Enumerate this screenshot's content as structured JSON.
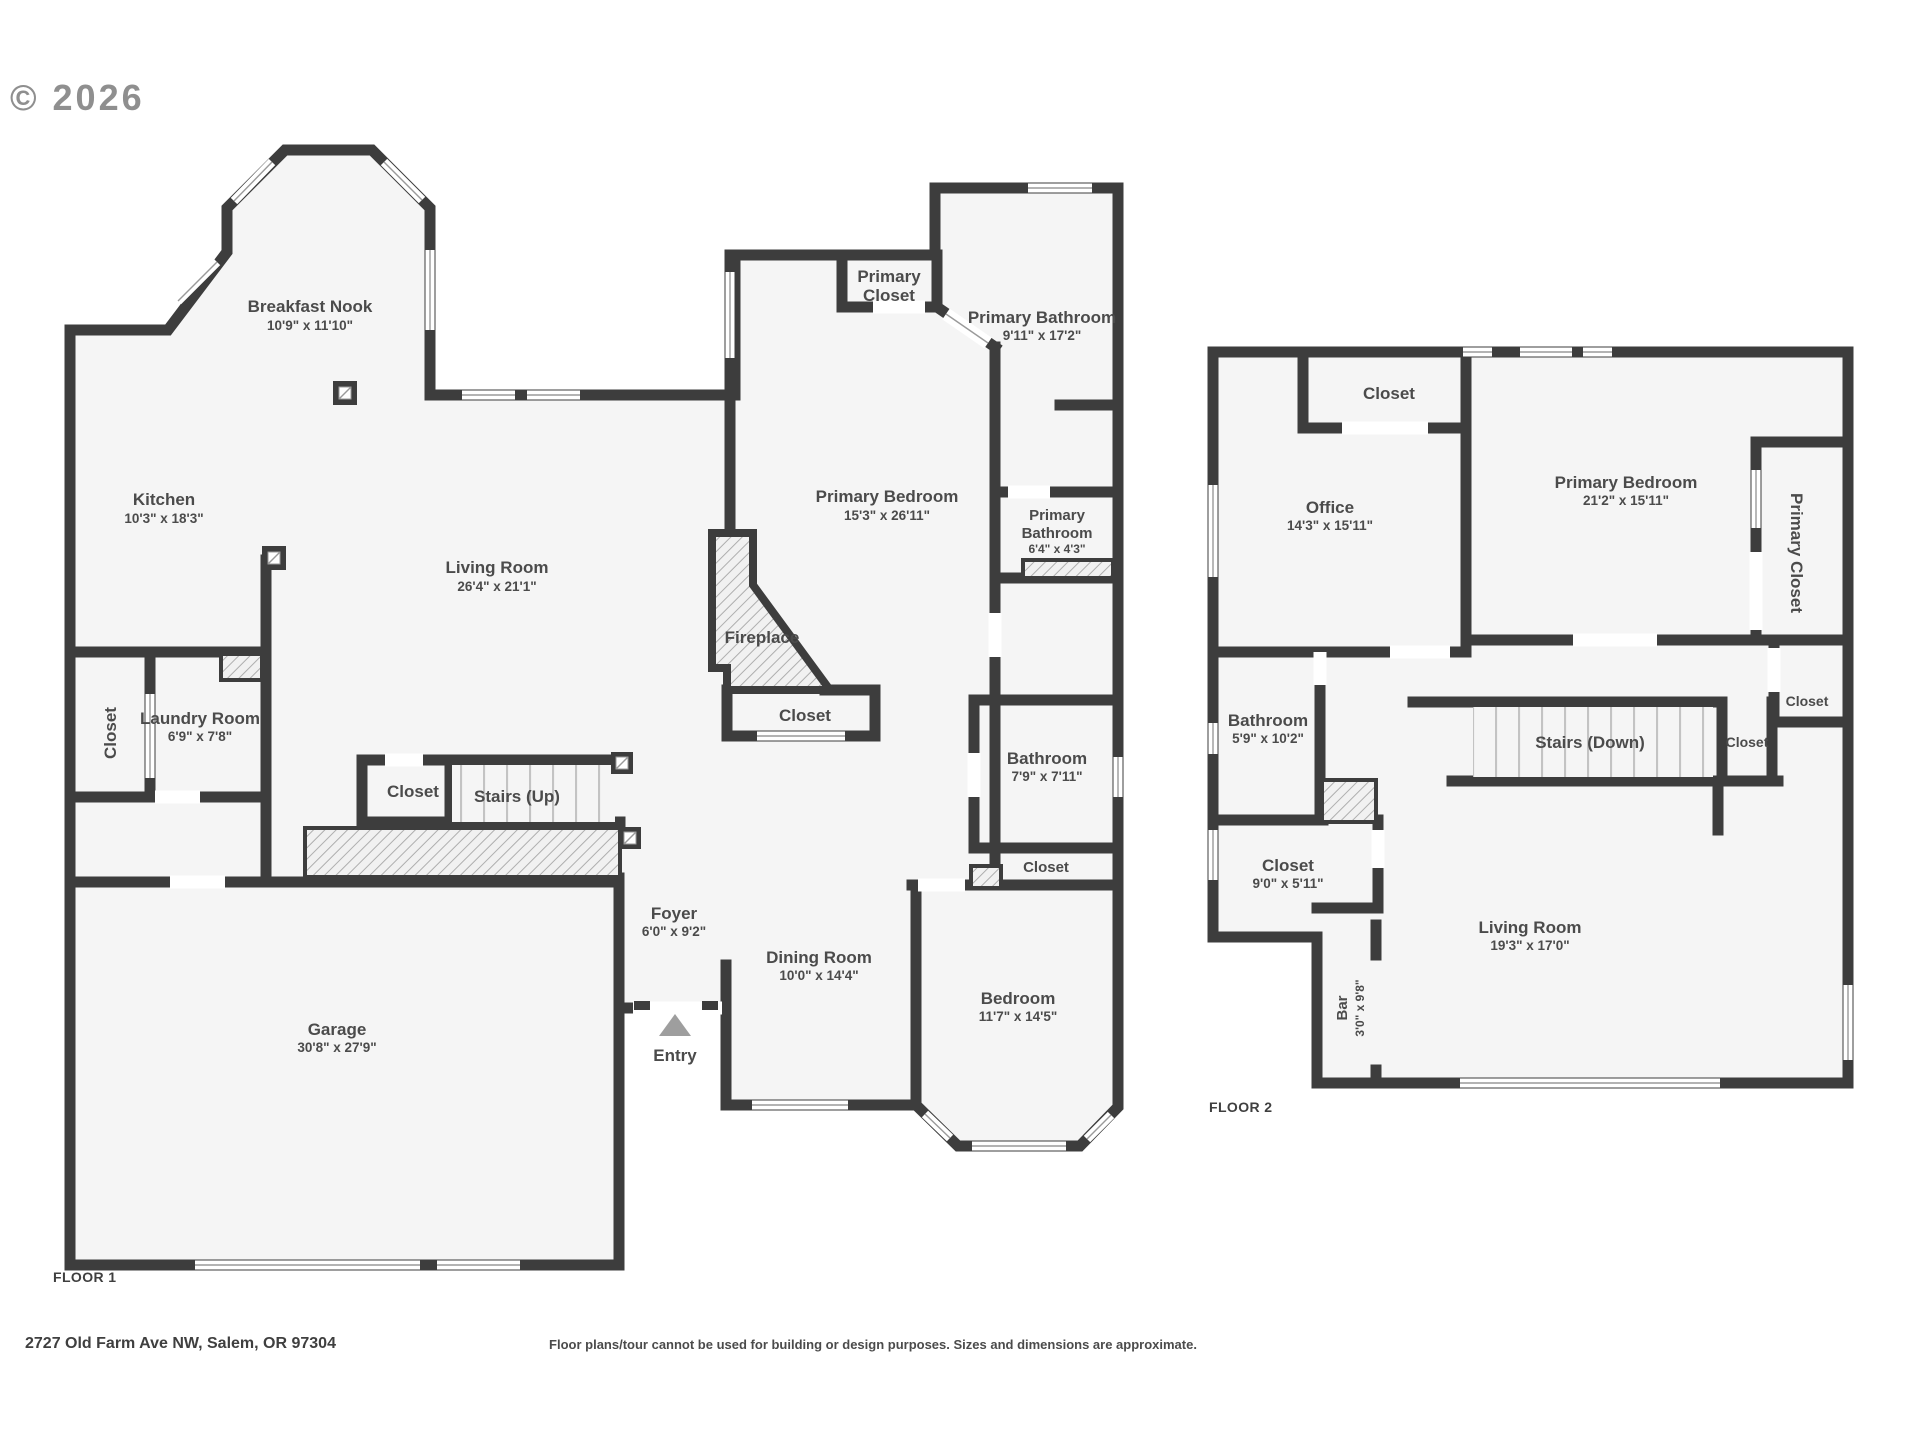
{
  "copyright": "© 2026",
  "floor1": {
    "label": "FLOOR 1",
    "breakfast_nook": {
      "name": "Breakfast Nook",
      "dims": "10'9\" x 11'10\""
    },
    "kitchen": {
      "name": "Kitchen",
      "dims": "10'3\" x 18'3\""
    },
    "living_room": {
      "name": "Living Room",
      "dims": "26'4\" x 21'1\""
    },
    "fireplace": {
      "name": "Fireplace"
    },
    "closet_fireplace": {
      "name": "Closet"
    },
    "primary_closet": {
      "line1": "Primary",
      "line2": "Closet"
    },
    "primary_bathroom_large": {
      "name": "Primary Bathroom",
      "dims": "9'11\" x 17'2\""
    },
    "primary_bedroom": {
      "name": "Primary Bedroom",
      "dims": "15'3\" x 26'11\""
    },
    "primary_bathroom_small": {
      "line1": "Primary",
      "line2": "Bathroom",
      "dims": "6'4\" x 4'3\""
    },
    "laundry_room": {
      "name": "Laundry Room",
      "dims": "6'9\" x 7'8\""
    },
    "closet_left": {
      "name": "Closet"
    },
    "closet_stairs": {
      "name": "Closet"
    },
    "stairs_up": {
      "name": "Stairs (Up)"
    },
    "bathroom": {
      "name": "Bathroom",
      "dims": "7'9\" x 7'11\""
    },
    "closet_bedroom": {
      "name": "Closet"
    },
    "bedroom": {
      "name": "Bedroom",
      "dims": "11'7\" x 14'5\""
    },
    "dining_room": {
      "name": "Dining Room",
      "dims": "10'0\" x 14'4\""
    },
    "foyer": {
      "name": "Foyer",
      "dims": "6'0\" x 9'2\""
    },
    "entry": {
      "name": "Entry"
    },
    "garage": {
      "name": "Garage",
      "dims": "30'8\" x 27'9\""
    }
  },
  "floor2": {
    "label": "FLOOR 2",
    "closet_office": {
      "name": "Closet"
    },
    "office": {
      "name": "Office",
      "dims": "14'3\" x 15'11\""
    },
    "primary_bedroom": {
      "name": "Primary Bedroom",
      "dims": "21'2\" x 15'11\""
    },
    "primary_closet": {
      "name": "Primary Closet"
    },
    "closet_right": {
      "name": "Closet"
    },
    "closet_stairs": {
      "name": "Closet"
    },
    "stairs_down": {
      "name": "Stairs (Down)"
    },
    "bathroom": {
      "name": "Bathroom",
      "dims": "5'9\" x 10'2\""
    },
    "closet_hall": {
      "name": "Closet",
      "dims": "9'0\" x 5'11\""
    },
    "living_room": {
      "name": "Living Room",
      "dims": "19'3\" x 17'0\""
    },
    "bar": {
      "name": "Bar",
      "dims": "3'0\" x 9'8\""
    }
  },
  "footer": {
    "address": "2727 Old Farm Ave NW, Salem, OR 97304",
    "disclaimer": "Floor plans/tour cannot be used for building or design purposes. Sizes and dimensions are approximate."
  },
  "colors": {
    "wall": "#3d3d3d",
    "floor": "#f5f5f5",
    "text": "#4b4b4b"
  }
}
